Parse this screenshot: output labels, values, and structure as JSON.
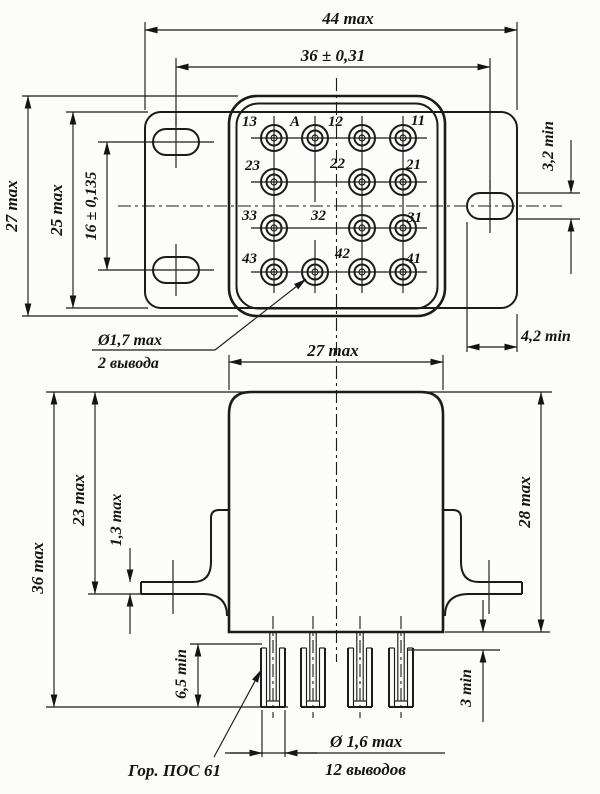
{
  "top_view": {
    "dims": {
      "d44": "44 max",
      "d36": "36 ± 0,31",
      "d27": "27 max",
      "d25": "25 max",
      "d16": "16 ± 0,135",
      "d32": "3,2 min",
      "d42": "4,2 min"
    },
    "callout_pins17": {
      "value": "Ø1,7 max",
      "note": "2 вывода"
    },
    "pin_labels": [
      "13",
      "A",
      "12",
      "11",
      "23",
      "22",
      "21",
      "33",
      "32",
      "31",
      "43",
      "42",
      "41"
    ]
  },
  "side_view": {
    "dims": {
      "d27": "27 max",
      "d36": "36 max",
      "d23": "23 max",
      "d13": "1,3 max",
      "d28": "28 max",
      "d65": "6,5 min",
      "d3": "3 min"
    },
    "callout_pins16": {
      "value": "Ø 1,6 max",
      "note": "12 выводов"
    },
    "solder_note": "Гор. ПОС 61"
  }
}
